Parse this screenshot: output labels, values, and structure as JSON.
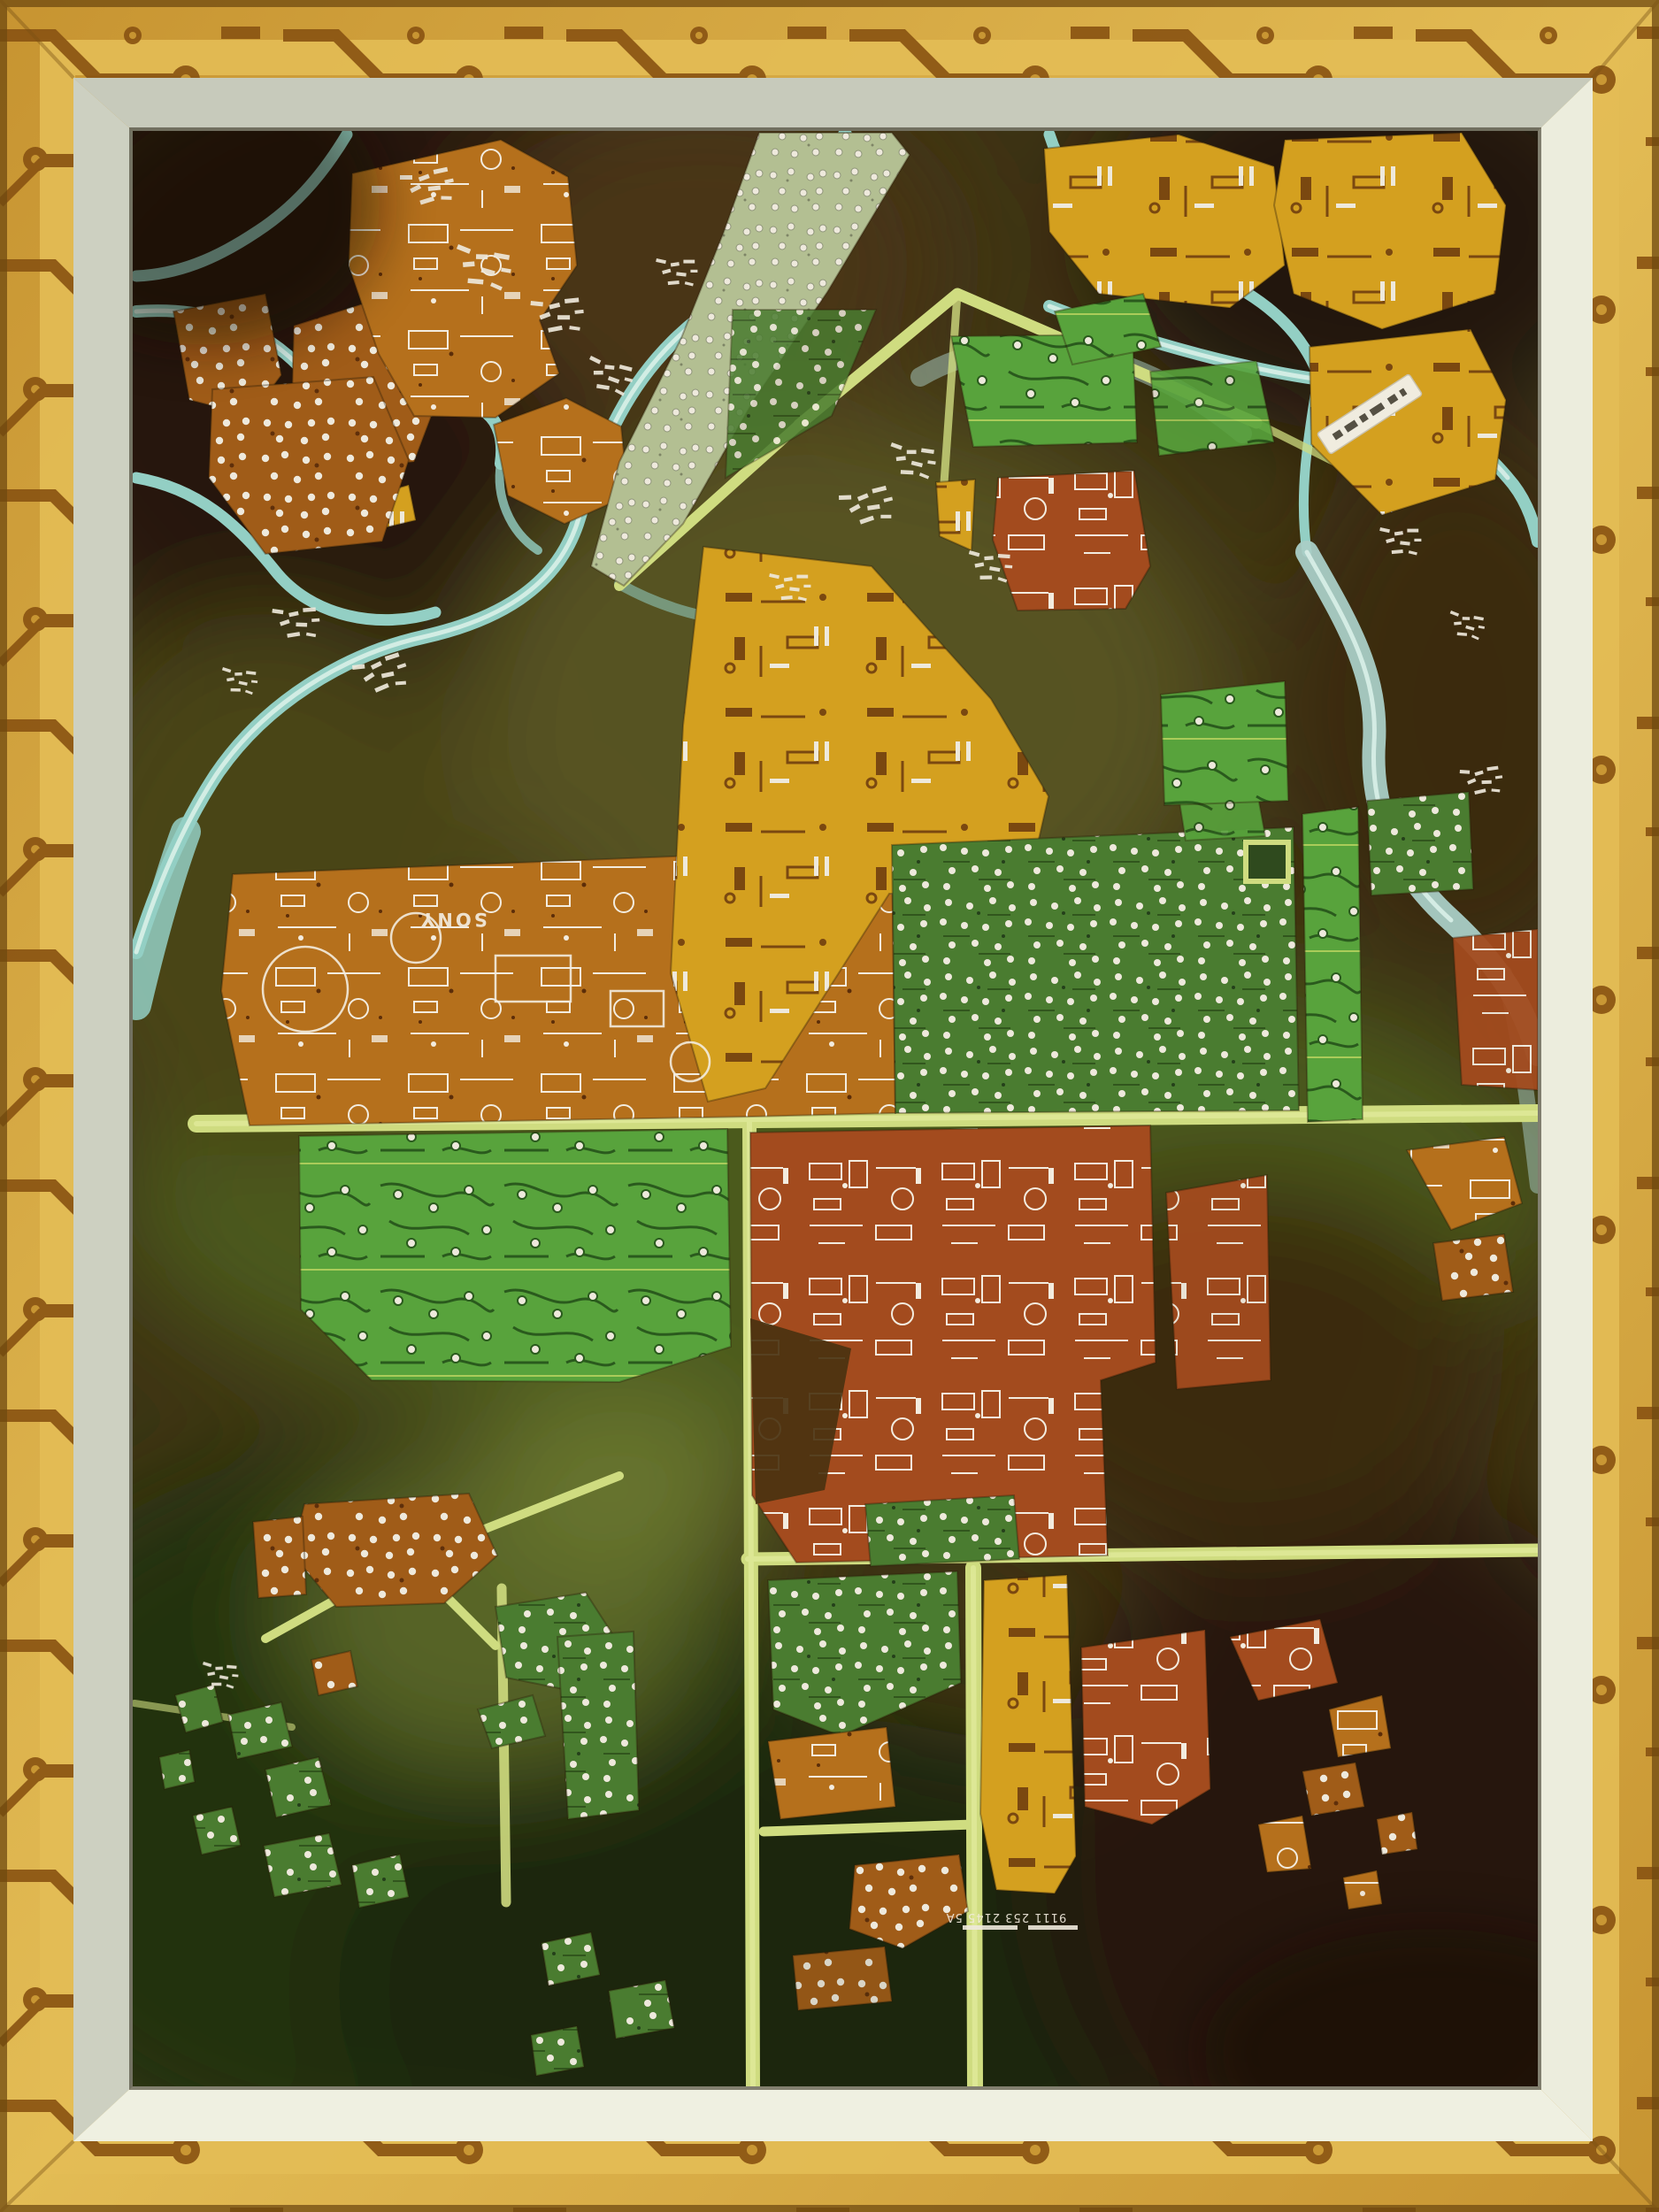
{
  "markings": {
    "pcb_brand": "SONY",
    "board_code": "9111 253 2145 5A"
  },
  "palette": {
    "frame_gold": "#c79431",
    "frame_gold_light": "#e3bc55",
    "frame_trace": "#8a5412",
    "frame_edge_dark": "#6f4a10",
    "mat_top": "#c7cabb",
    "mat_left": "#cdd0c1",
    "mat_right": "#eceddd",
    "mat_bottom": "#eff0e1",
    "canvas_base": "#3e3414",
    "canvas_dark_brown": "#261607",
    "canvas_brown": "#4a3413",
    "canvas_olive": "#565320",
    "canvas_green": "#4c5a1e",
    "canvas_green_dark": "#223010",
    "canvas_dark_bottom": "#1d250c",
    "river": "#93cfc4",
    "river_light": "#d9efe8",
    "river_grey": "#a9cec6",
    "road": "#cfdc80",
    "road_bright": "#e0ea9a",
    "pcb_copper": "#b5701c",
    "pcb_copper_dark": "#a05c18",
    "pcb_gold": "#d4a01f",
    "pcb_red": "#a34b1e",
    "pcb_green": "#4a7c30",
    "pcb_green_bright": "#58a33c",
    "pcb_green_dark": "#2f4a1e",
    "city_strip": "#b3bf92",
    "silkscreen": "#f3ecdf",
    "solder": "#eee9dc",
    "trace_green": "#2a5a1d",
    "label_white": "#f0ecdf"
  }
}
